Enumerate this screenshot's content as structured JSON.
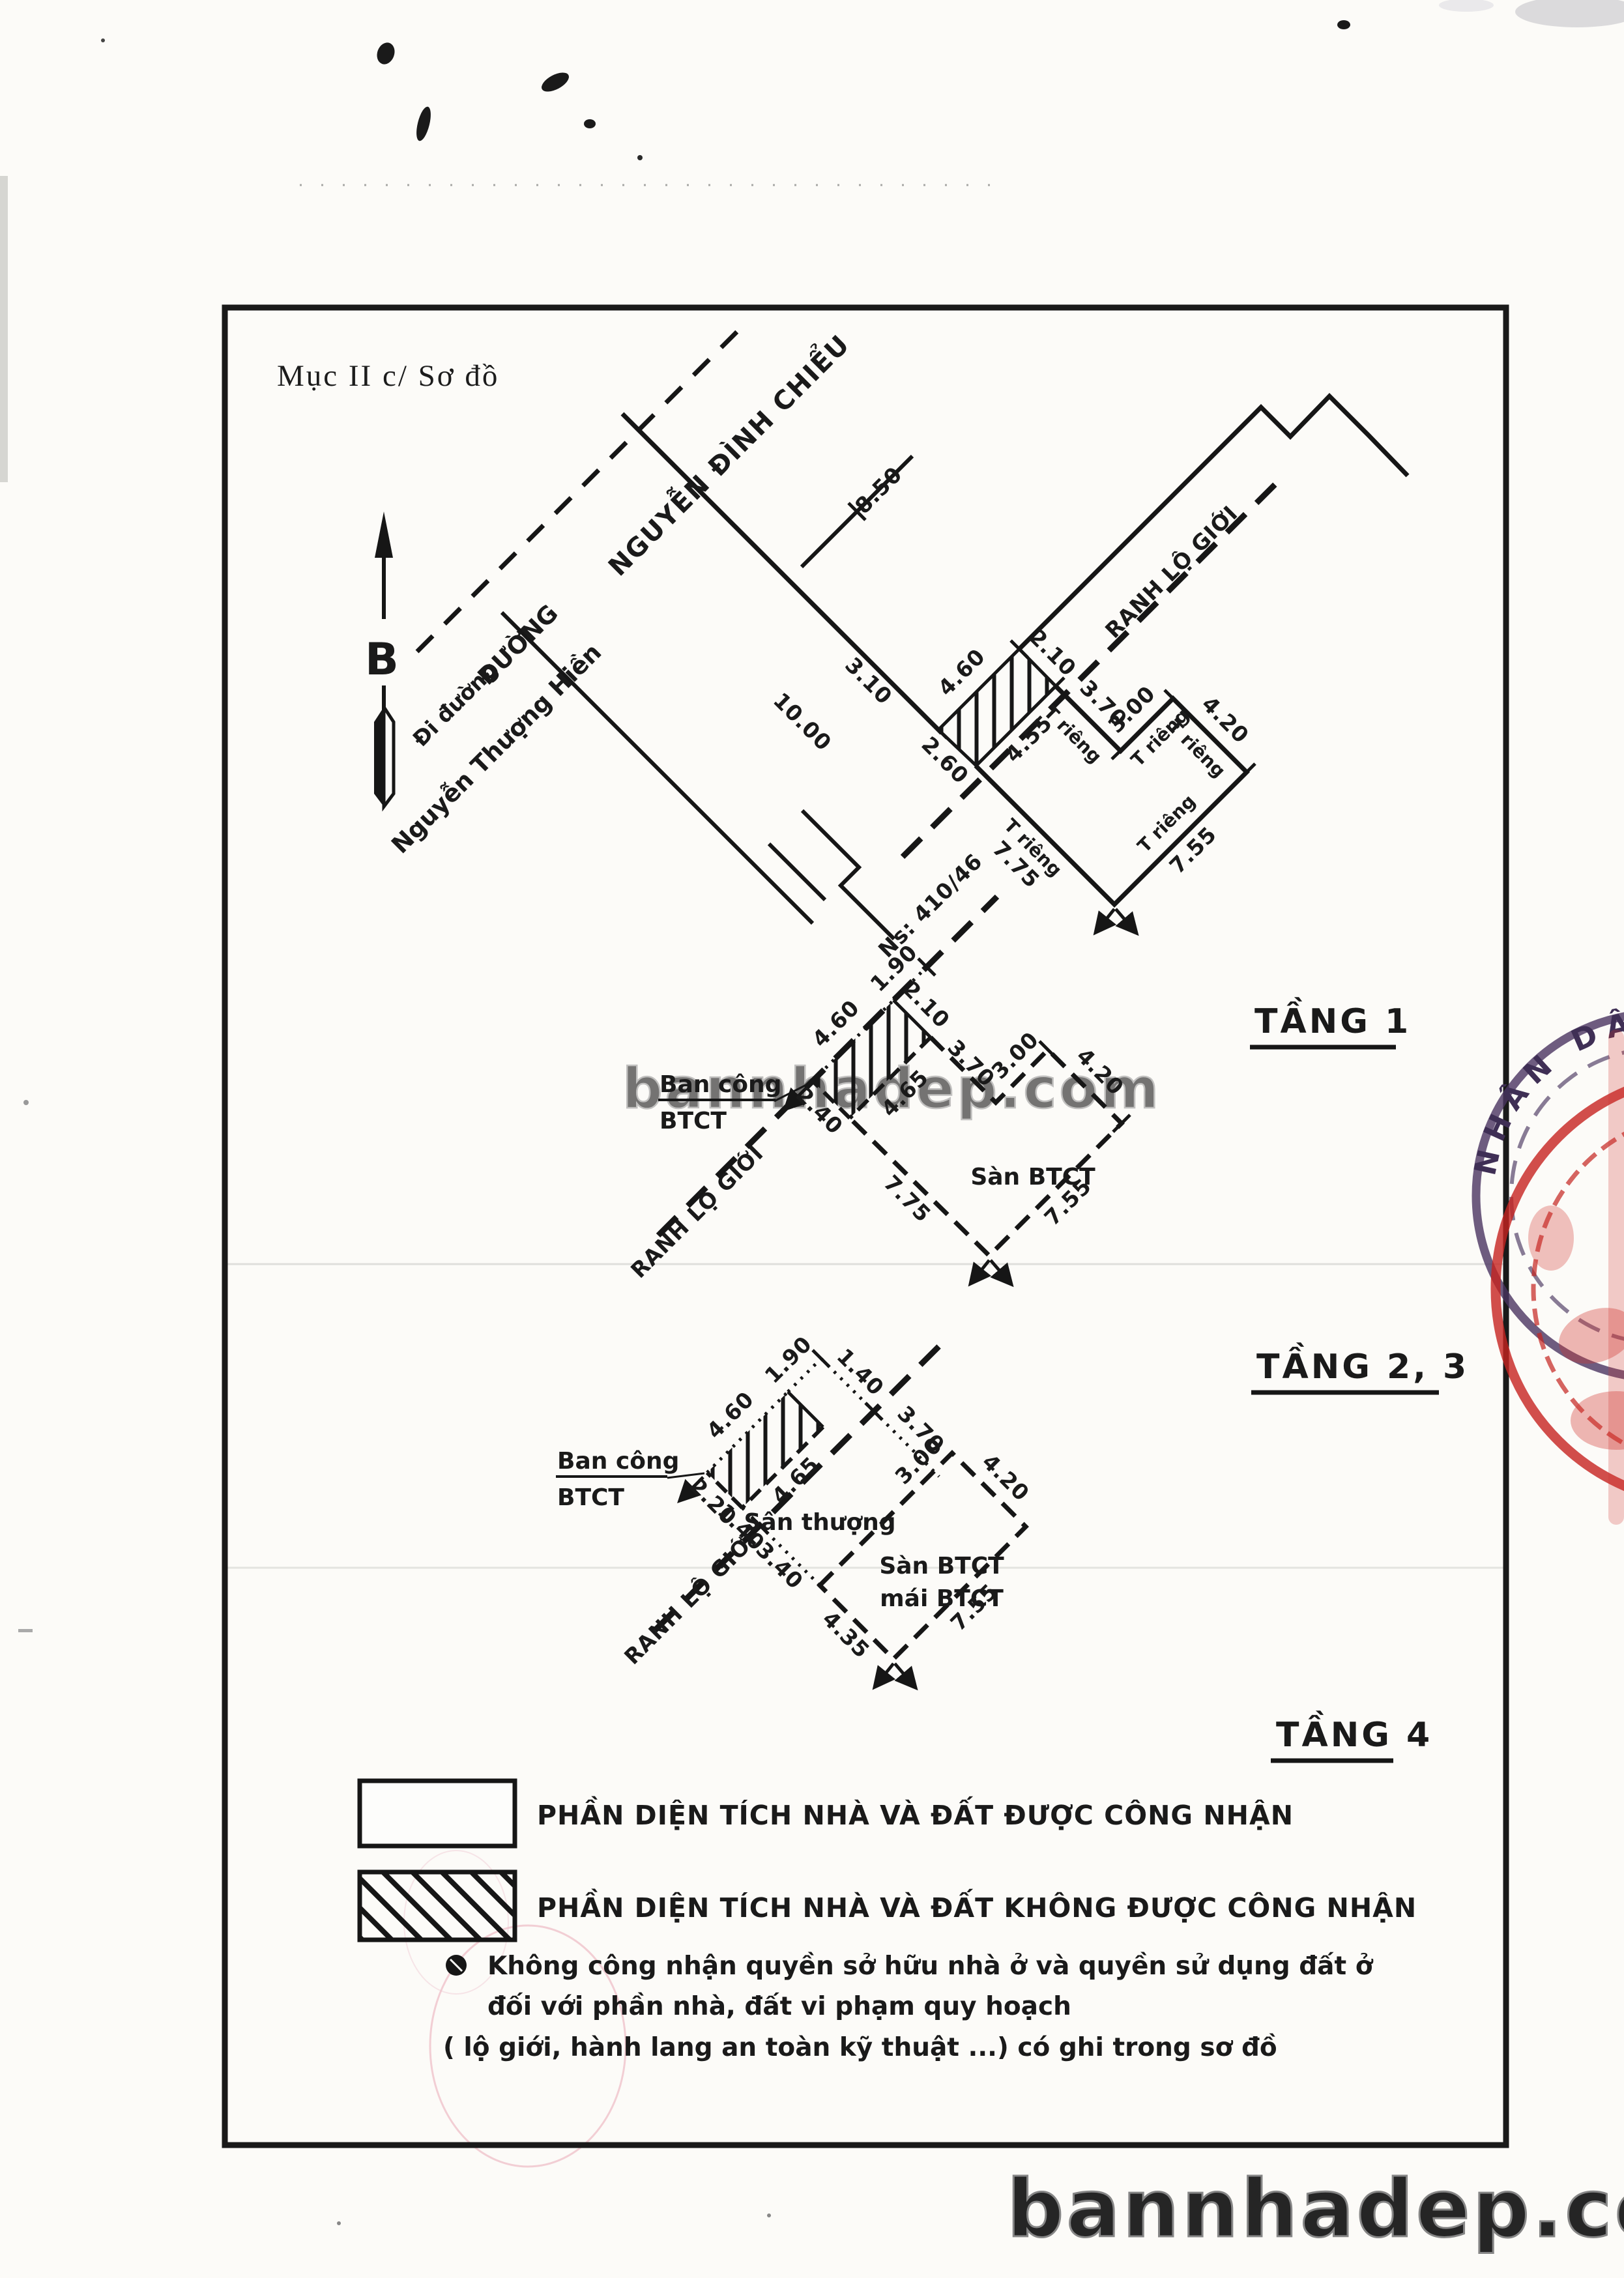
{
  "title": "Mục II c/ Sơ đồ",
  "compass": {
    "north": "B"
  },
  "streets": {
    "di_duong": "Đi đường",
    "nguyen_thuong_hien": "Nguyễn Thượng Hiền",
    "duong": "ĐƯỜNG",
    "nguyen_dinh_chieu": "NGUYỄN ĐÌNH CHIỂU",
    "width_850": "8.50",
    "width_1000": "10.00",
    "frontage_310": "3.10",
    "house_no": "Ns: 410/46"
  },
  "labels": {
    "ranh_lo_gioi": "RANH LỘ GIỚI",
    "t_rieng": "T riêng",
    "ban_cong": "Ban công",
    "btct": "BTCT"
  },
  "floor1": {
    "name": "TẦNG 1",
    "hatch": {
      "front": "4.60",
      "right": "2.10",
      "back": "4.55",
      "left": "2.60"
    },
    "parcel": {
      "a": "3.70",
      "b": "3.00",
      "c": "4.20",
      "d": "7.55",
      "e": "7.75"
    }
  },
  "floor23": {
    "name": "TẦNG 2, 3",
    "san_btct": "Sàn BTCT",
    "hatch": {
      "front": "4.60",
      "tick": "1.90",
      "right": "2.10",
      "back": "4.65",
      "left": "2.40"
    },
    "parcel": {
      "a": "3.70",
      "b": "3.00",
      "c": "4.20",
      "d": "7.55",
      "e": "7.75"
    }
  },
  "floor4": {
    "name": "TẦNG 4",
    "san_thuong": "Sân thượng",
    "san_btct": "Sàn BTCT",
    "mai_btct": "mái BTCT",
    "hatch": {
      "front": "4.60",
      "tick": "1.90",
      "top_gap": "1.40",
      "left": "2.20",
      "bottom_gap": "1.40",
      "back": "4.65"
    },
    "parcel": {
      "a": "3.70",
      "b": "3.00",
      "c": "4.20",
      "d": "7.55",
      "e": "4.35",
      "f": "3.40"
    }
  },
  "legend": {
    "recognized": "PHẦN DIỆN TÍCH NHÀ VÀ ĐẤT ĐƯỢC CÔNG NHẬN",
    "not_recognized": "PHẦN DIỆN TÍCH NHÀ VÀ ĐẤT KHÔNG ĐƯỢC CÔNG NHẬN",
    "note1": "Không công nhận quyền sở hữu nhà ở và quyền sử dụng đất ở",
    "note2": "đối với phần nhà, đất vi phạm quy hoạch",
    "note3": "( lộ giới, hành lang an toàn kỹ thuật ...) có ghi trong sơ đồ"
  },
  "watermark": "bannhadep.com",
  "stamp": {
    "arc_text": "NHÂN DÂN"
  },
  "colors": {
    "ink": "#1a1a1a",
    "stamp_red": "#c5231f",
    "stamp_purple": "#46325a",
    "watermark_gray": "#8f8f8f"
  }
}
